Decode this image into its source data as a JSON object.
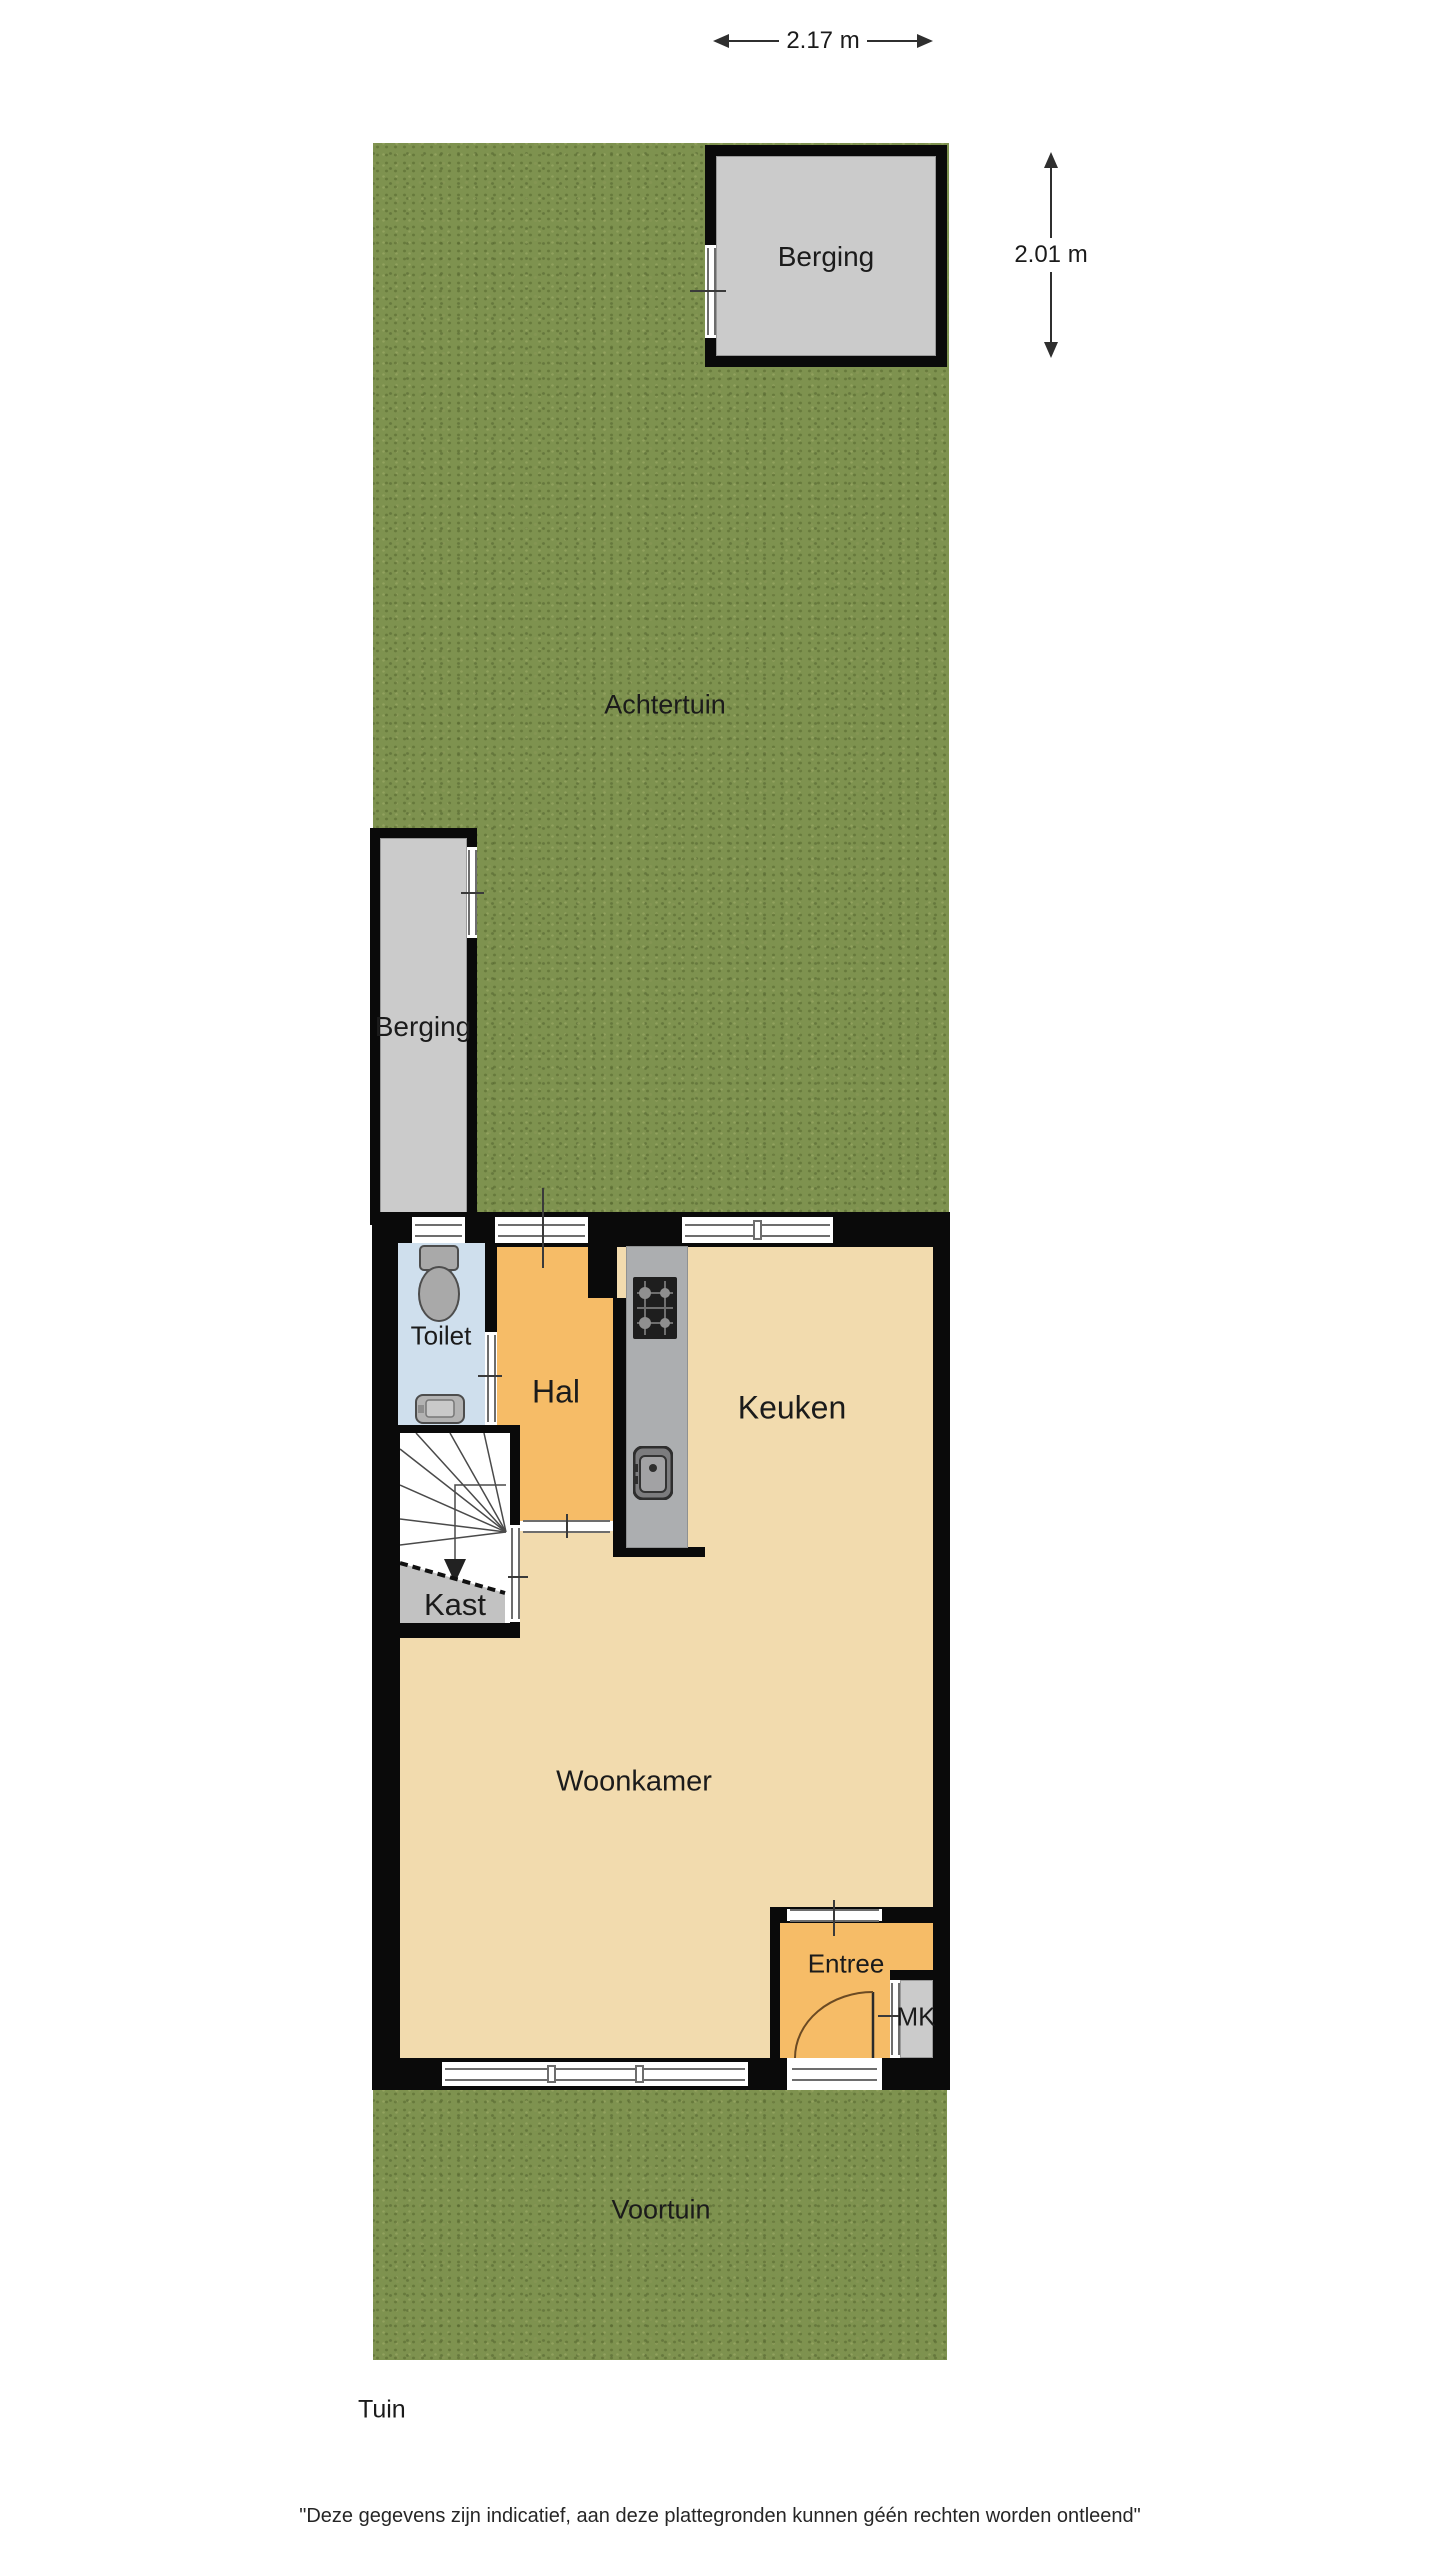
{
  "plan": {
    "dimensions": {
      "width_label": "2.17 m",
      "height_label": "2.01 m"
    },
    "labels": {
      "achtertuin": "Achtertuin",
      "voortuin": "Voortuin",
      "berging_top": "Berging",
      "berging_left": "Berging",
      "toilet": "Toilet",
      "hal": "Hal",
      "keuken": "Keuken",
      "kast": "Kast",
      "woonkamer": "Woonkamer",
      "entree": "Entree",
      "mk": "MK"
    },
    "footer": {
      "title": "Tuin",
      "disclaimer": "\"Deze gegevens zijn indicatief, aan deze plattegronden kunnen géén rechten worden ontleend\""
    }
  },
  "colors": {
    "grass": "#7e924f",
    "wall": "#0a0a0a",
    "hall_orange": "#f6bc67",
    "floor_tan": "#f2dbae",
    "toilet_blue": "#cfdfed",
    "shed_gray": "#cbcbcb",
    "counter_gray": "#acaeb0"
  }
}
